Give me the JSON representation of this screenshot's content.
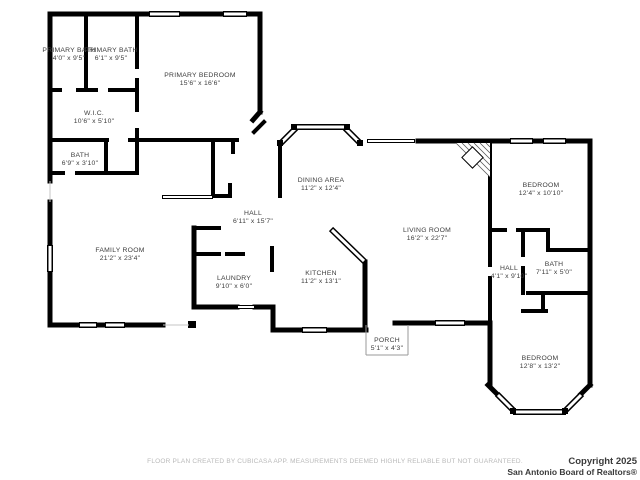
{
  "colors": {
    "walls": "#000000",
    "labels": "#3d3d3d",
    "disclaimer_text": "#b9b9b9",
    "copyright_text": "#3a3a3a",
    "background": "#ffffff"
  },
  "rooms": {
    "primary_bath_1": {
      "name": "PRIMARY BATH",
      "dims": "4'0\" x 9'5\""
    },
    "primary_bath_2": {
      "name": "PRIMARY BATH",
      "dims": "6'1\" x 9'5\""
    },
    "primary_bedroom": {
      "name": "PRIMARY BEDROOM",
      "dims": "15'6\" x 16'6\""
    },
    "wic": {
      "name": "W.I.C.",
      "dims": "10'6\" x 5'10\""
    },
    "bath_1": {
      "name": "BATH",
      "dims": "6'9\" x 3'10\""
    },
    "family_room": {
      "name": "FAMILY ROOM",
      "dims": "21'2\" x 23'4\""
    },
    "hall_1": {
      "name": "HALL",
      "dims": "6'11\" x 15'7\""
    },
    "dining_area": {
      "name": "DINING AREA",
      "dims": "11'2\" x 12'4\""
    },
    "living_room": {
      "name": "LIVING ROOM",
      "dims": "16'2\" x 22'7\""
    },
    "bedroom_1": {
      "name": "BEDROOM",
      "dims": "12'4\" x 10'10\""
    },
    "hall_2": {
      "name": "HALL",
      "dims": "4'1\" x 9'10\""
    },
    "bath_2": {
      "name": "BATH",
      "dims": "7'11\" x 5'0\""
    },
    "bedroom_2": {
      "name": "BEDROOM",
      "dims": "12'8\" x 13'2\""
    },
    "laundry": {
      "name": "LAUNDRY",
      "dims": "9'10\" x 6'0\""
    },
    "kitchen": {
      "name": "KITCHEN",
      "dims": "11'2\" x 13'1\""
    },
    "porch": {
      "name": "PORCH",
      "dims": "5'1\" x 4'3\""
    }
  },
  "footer": {
    "disclaimer": "FLOOR PLAN CREATED BY CUBICASA APP. MEASUREMENTS DEEMED HIGHLY RELIABLE BUT NOT GUARANTEED.",
    "copyright": "Copyright 2025",
    "organization": "San Antonio Board of Realtors®"
  }
}
